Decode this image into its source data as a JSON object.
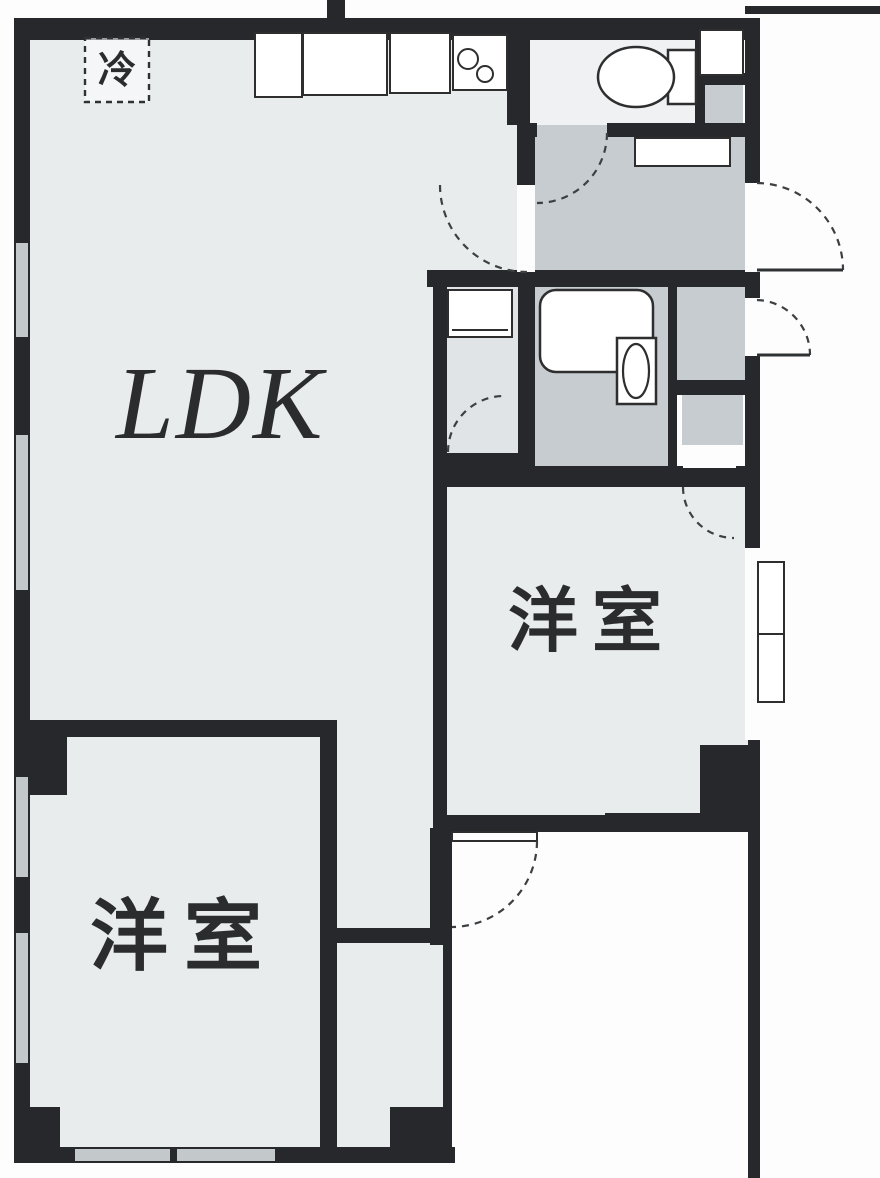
{
  "diagram": {
    "type": "apartment-floor-plan",
    "style": "japanese-real-estate-madori"
  },
  "rooms": {
    "ldk": {
      "label": "LDK",
      "meaning": "living-dining-kitchen"
    },
    "bedroom_bottom": {
      "label": "洋室",
      "meaning": "western-style-room"
    },
    "bedroom_right": {
      "label": "洋室",
      "meaning": "western-style-room"
    },
    "refrigerator_space": {
      "label": "冷",
      "meaning": "refrigerator-space"
    }
  },
  "fixtures": [
    "kitchen-counter",
    "kitchen-sink-burners",
    "refrigerator-space",
    "toilet",
    "bathtub",
    "washbasin",
    "washing-machine-pan",
    "shoe-cabinet",
    "entrance-door",
    "storage-exterior-door",
    "toilet-door",
    "ldk-door",
    "washroom-door",
    "closet-door",
    "terrace-door",
    "sliding-windows"
  ],
  "colors": {
    "wall": "#26282b",
    "room_floor": "#e9eced",
    "hall_floor": "#c7ccd0",
    "toilet_floor": "#eff1f2",
    "washroom_floor": "#e0e4e6",
    "outside": "#fdfdfd",
    "line": "#2e2e2e",
    "window": "#c3c8ca"
  }
}
